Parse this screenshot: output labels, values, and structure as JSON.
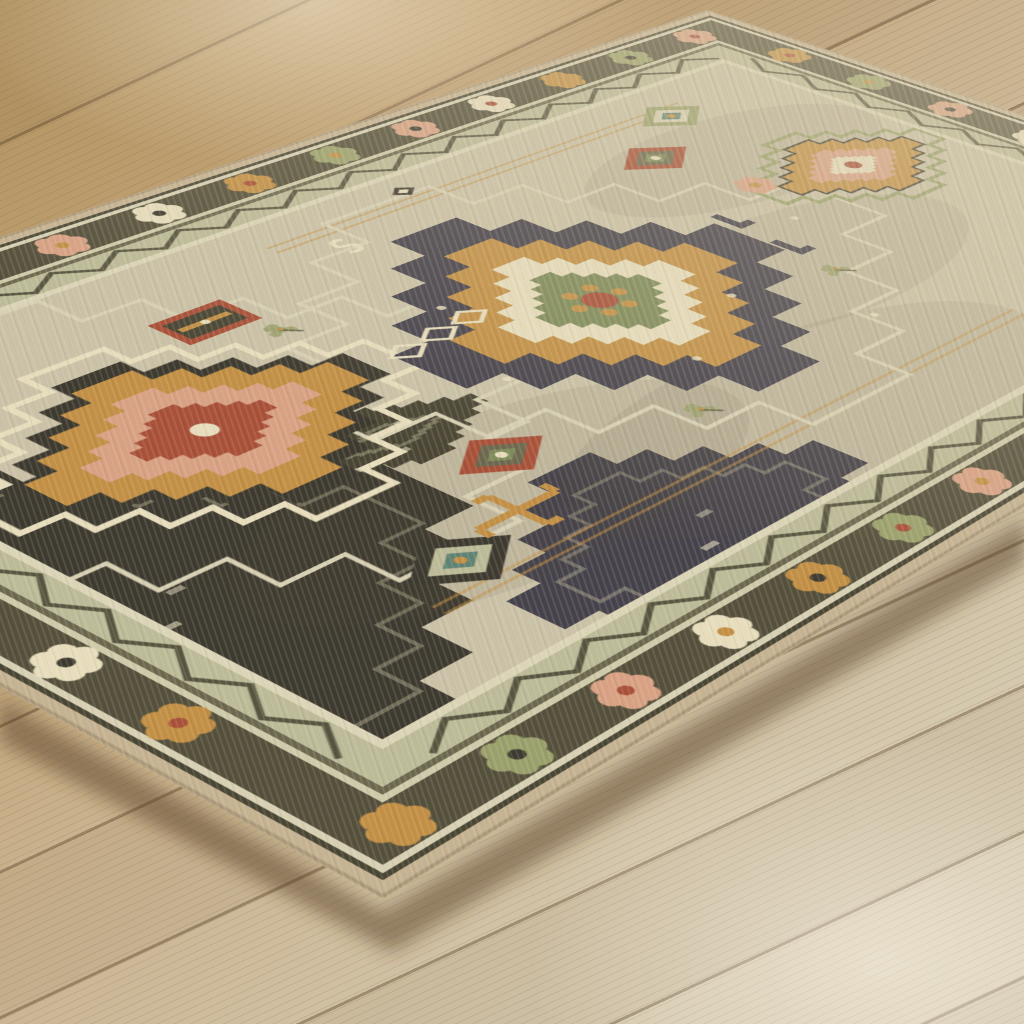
{
  "scene": {
    "description": "Angled close-up photo of a beige, olive, gold and rust tribal medallion area rug with a serged tan edge, lying on a pale oak wide-plank wood floor; bare floor shows in the upper-left strip and lower-right triangle.",
    "aria_label": "Tribal medallion area rug on light oak wood plank flooring"
  },
  "css_vars": {
    "wood0": "#b2925f",
    "wood1": "#c2a478",
    "wood2": "#cbb694",
    "wood3": "#d3c6ab",
    "wood4": "#d9ceb6",
    "seam": "rgba(90,66,40,0.42)",
    "grain": "rgba(100,76,48,0.13)",
    "hl-top": "rgba(255,247,226,0.50)",
    "hl-bot": "rgba(252,246,232,0.50)",
    "haze": "rgba(219,207,177,0.55)",
    "streakL": "rgba(255,255,255,0.10)",
    "streakD": "rgba(64,56,42,0.07)"
  },
  "rug": {
    "screen_outline_px": [
      [
        708,
        10
      ],
      [
        1024,
        115
      ],
      [
        1024,
        507
      ],
      [
        383,
        899
      ],
      [
        0,
        687
      ],
      [
        0,
        237
      ]
    ],
    "matrix3d": [
      1.13338,
      -0.27632,
      0,
      0.00036796,
      0.91181,
      0.35303,
      0,
      -0.00022157,
      0,
      0,
      1,
      0,
      -514,
      402,
      0,
      1
    ],
    "canvas": {
      "w": 1400,
      "h": 900
    },
    "palette": {
      "binding": "#c5b291",
      "outer_dark": "#4a4634",
      "pale": "#d7d0b3",
      "main_border": "#55503b",
      "pale2": "#cfcaa9",
      "olive": "#6c684e",
      "sage_band": "#bcba97",
      "cream": "#dbd4b6",
      "field": "#cac1a6",
      "zigzag": "#45422f",
      "gold": "#c28f44",
      "peach": "#d8a183",
      "rust": "#a85038",
      "cream_motif": "#e7ddbc",
      "moss": "#7e8a58",
      "charcoal": "#46424b",
      "teal": "#5f8273",
      "sage_motif": "#9aa06b",
      "dark_brown": "#3e3a2f"
    },
    "borders": [
      {
        "name": "binding",
        "from": 0,
        "to": 13,
        "color_key": "binding"
      },
      {
        "name": "outer-guard",
        "from": 13,
        "to": 18,
        "color_key": "outer_dark"
      },
      {
        "name": "pale-guard",
        "from": 18,
        "to": 24,
        "color_key": "pale"
      },
      {
        "name": "main-border",
        "from": 24,
        "to": 70,
        "color_key": "main_border"
      },
      {
        "name": "pale-stripe",
        "from": 70,
        "to": 76,
        "color_key": "pale2"
      },
      {
        "name": "olive-stripe",
        "from": 76,
        "to": 82,
        "color_key": "olive"
      },
      {
        "name": "zigzag-band",
        "from": 82,
        "to": 112,
        "color_key": "sage_band"
      },
      {
        "name": "inner-guard",
        "from": 112,
        "to": 120,
        "color_key": "cream"
      }
    ],
    "field_inset": 120,
    "rosettes": {
      "spacing": 105,
      "inset_center": 47,
      "petal_r": 10,
      "core_r": 6,
      "colors": [
        "peach",
        "cream_motif",
        "gold",
        "sage_motif"
      ],
      "cores": [
        "rust",
        "gold",
        "dark_brown"
      ]
    },
    "zigzag": {
      "inset_center": 97,
      "half": 34,
      "amp": 11
    },
    "motifs": [
      {
        "type": "panel",
        "name": "corner-dark-panel",
        "x": 136,
        "y": 560,
        "rx": 250,
        "ry": 235,
        "fill": "dark_brown"
      },
      {
        "type": "panel",
        "name": "bottom-pendant-panel",
        "x": 476,
        "y": 745,
        "rx": 175,
        "ry": 135,
        "fill": "charcoal"
      },
      {
        "type": "panel",
        "name": "side-dark-panel",
        "x": 425,
        "y": 487,
        "rx": 95,
        "ry": 48,
        "fill": "outer_dark"
      },
      {
        "type": "blotch",
        "x": 420,
        "y": 610,
        "rx": 250,
        "ry": 110
      },
      {
        "type": "blotch",
        "x": 700,
        "y": 690,
        "rx": 280,
        "ry": 120
      },
      {
        "type": "blotch",
        "x": 920,
        "y": 500,
        "rx": 220,
        "ry": 100
      },
      {
        "type": "blotch",
        "x": 1080,
        "y": 300,
        "rx": 200,
        "ry": 90
      },
      {
        "type": "rail",
        "x1": 600,
        "x2": 1150,
        "y": 165
      },
      {
        "type": "rail",
        "x1": 260,
        "x2": 980,
        "y": 688
      },
      {
        "type": "outline",
        "name": "left-cartouche",
        "x": 332,
        "y": 384,
        "rx": 305,
        "ry": 262,
        "stroke": "pale",
        "w": 5
      },
      {
        "type": "outline",
        "name": "center-cartouche",
        "x": 739,
        "y": 429,
        "rx": 330,
        "ry": 272,
        "stroke": "pale",
        "w": 5
      },
      {
        "type": "medallion",
        "name": "left-medallion",
        "x": 332,
        "y": 384,
        "flower": {
          "r": 11,
          "fill": "cream_motif",
          "dots": "rust"
        },
        "layers": [
          {
            "rx": 196,
            "ry": 158,
            "fill": "none",
            "stroke": "cream_motif",
            "w": 7
          },
          {
            "rx": 168,
            "ry": 132,
            "fill": "dark_brown"
          },
          {
            "rx": 148,
            "ry": 114,
            "fill": "gold"
          },
          {
            "rx": 104,
            "ry": 80,
            "fill": "peach"
          },
          {
            "rx": 64,
            "ry": 48,
            "fill": "rust"
          }
        ]
      },
      {
        "type": "medallion",
        "name": "center-medallion",
        "x": 729,
        "y": 429,
        "flower": {
          "r": 16,
          "fill": "rust",
          "dots": "gold"
        },
        "layers": [
          {
            "rx": 205,
            "ry": 205,
            "fill": "charcoal"
          },
          {
            "rx": 150,
            "ry": 152,
            "fill": "gold"
          },
          {
            "rx": 103,
            "ry": 105,
            "fill": "cream_motif"
          },
          {
            "rx": 66,
            "ry": 68,
            "fill": "moss"
          }
        ]
      },
      {
        "type": "medallion",
        "name": "upper-right-medallion",
        "x": 1150,
        "y": 386,
        "flower": {
          "r": 9,
          "fill": "rust"
        },
        "layers": [
          {
            "rx": 128,
            "ry": 90,
            "fill": "none",
            "stroke": "sage_motif",
            "w": 6
          },
          {
            "rx": 100,
            "ry": 70,
            "fill": "gold",
            "stroke": "dark_brown",
            "w": 3
          },
          {
            "rx": 62,
            "ry": 43,
            "fill": "peach"
          },
          {
            "rx": 33,
            "ry": 23,
            "fill": "cream_motif"
          }
        ]
      },
      {
        "type": "smallDiamond",
        "name": "teal-diamond",
        "x": 321,
        "y": 656,
        "rx": 52,
        "ry": 38,
        "rings": [
          "dark_brown",
          "sage_band",
          "teal"
        ],
        "dot": "gold"
      },
      {
        "type": "smallDiamond",
        "name": "green-diamond",
        "x": 1116,
        "y": 185,
        "rx": 44,
        "ry": 32,
        "rings": [
          "sage_motif",
          "pale",
          "teal"
        ],
        "dot": "gold"
      },
      {
        "type": "smallDiamond",
        "name": "rust-diamond-a",
        "x": 460,
        "y": 566,
        "rx": 46,
        "ry": 33,
        "rings": [
          "rust",
          "olive",
          "moss"
        ],
        "dot": "cream_motif"
      },
      {
        "type": "smallDiamond",
        "name": "rust-diamond-b",
        "x": 1017,
        "y": 248,
        "rx": 46,
        "ry": 33,
        "rings": [
          "rust",
          "olive",
          "moss"
        ],
        "dot": "cream_motif"
      },
      {
        "type": "rect",
        "name": "rust-flag-rect",
        "x": 462,
        "y": 241,
        "w": 76,
        "h": 50
      },
      {
        "type": "hookCross",
        "name": "gold-hook-cross",
        "x": 404,
        "y": 634,
        "s": 42
      },
      {
        "type": "sprig",
        "x": 494,
        "y": 292
      },
      {
        "type": "sprig",
        "x": 628,
        "y": 622
      },
      {
        "type": "sprig",
        "x": 932,
        "y": 528
      },
      {
        "type": "rosetteMotif",
        "name": "field-peach-rosette",
        "x": 1036,
        "y": 355
      },
      {
        "type": "star",
        "x": 779,
        "y": 150
      },
      {
        "type": "sMotif",
        "x": 657,
        "y": 206
      },
      {
        "type": "diamondChain",
        "x": 540,
        "y": 390,
        "n": 3,
        "step": 42
      },
      {
        "type": "hook",
        "x": 948,
        "y": 392
      },
      {
        "type": "hook",
        "x": 942,
        "y": 466
      },
      {
        "type": "dot",
        "x": 560,
        "y": 480
      },
      {
        "type": "dot",
        "x": 700,
        "y": 560
      },
      {
        "type": "dot",
        "x": 820,
        "y": 500
      },
      {
        "type": "dot",
        "x": 620,
        "y": 350
      },
      {
        "type": "dot",
        "x": 880,
        "y": 610
      },
      {
        "type": "dot",
        "x": 1000,
        "y": 430
      }
    ]
  },
  "overlays": {
    "shadow_color": "rgba(85,60,35,0.50)",
    "shadow_polygon": [
      [
        0,
        700
      ],
      [
        383,
        912
      ],
      [
        1026,
        520
      ],
      [
        1026,
        562
      ],
      [
        392,
        952
      ],
      [
        0,
        742
      ]
    ]
  }
}
